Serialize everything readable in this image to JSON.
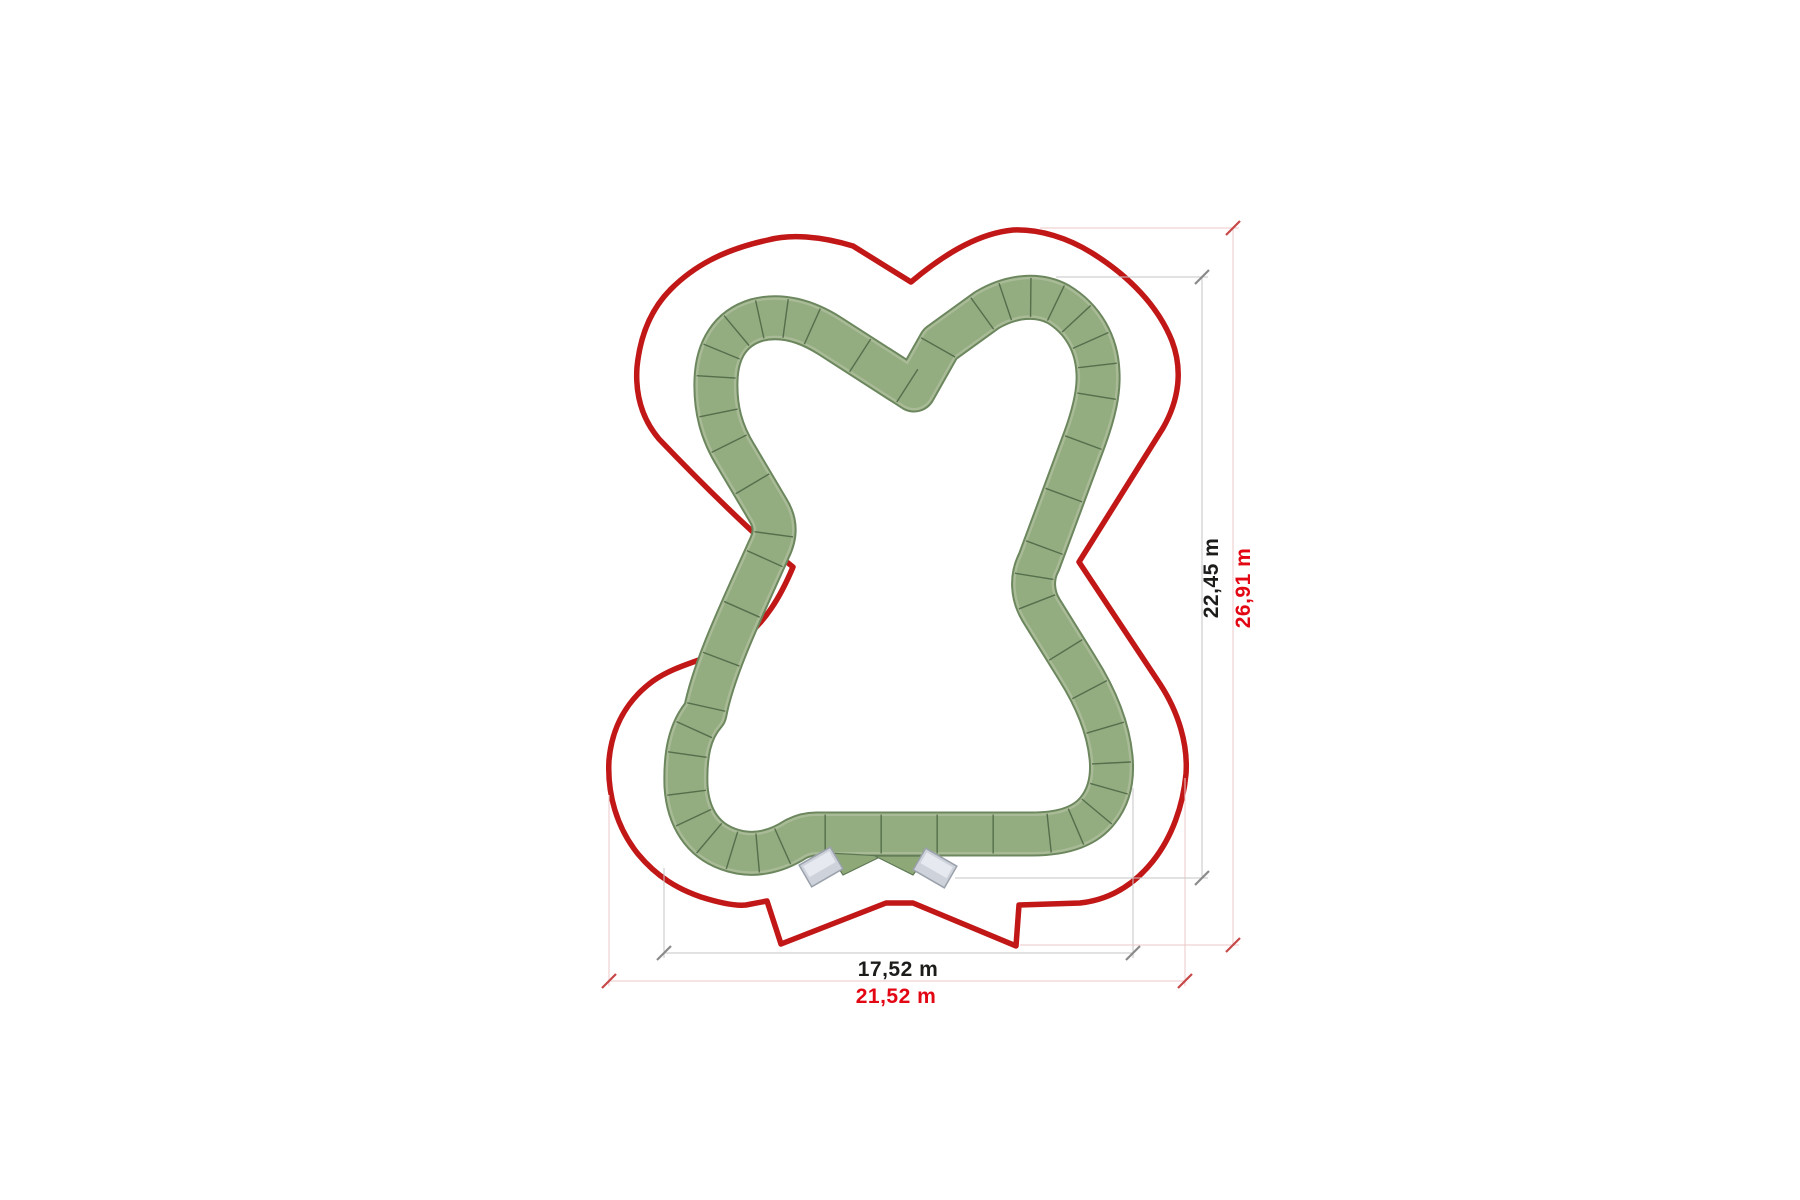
{
  "title": "Pump track plan view with dimensions",
  "units": "m",
  "colors": {
    "boundary_red": "#c21717",
    "label_black": "#1c1c1a",
    "label_red": "#e30613",
    "track_green": "#93ac80",
    "track_edge_green": "#6c875e",
    "track_rim_green": "#a9bb96",
    "divider_green": "#4f6847",
    "ramp_gray": "#ced3db",
    "ramp_border_gray": "#9aa1ab",
    "dim_gray_line": "#c6c6c6",
    "dim_red_line": "#ecc8c8"
  },
  "shapes": {
    "boundary_path": "M 911 282 L 853 246 C 820 236 790 234 768 240 C 722 250 693 267 671 289 C 650 310 640 337 637 367 C 635 396 643 420 659 439 C 703 485 757 538 793 567 C 780 598 765 622 742 640 C 712 660 680 662 653 681 C 627 700 612 727 609 760 C 607 794 617 828 638 854 C 657 877 678 889 701 897 C 720 903 736 906 746 905 L 767 901 L 781 944 L 886 903 L 913 903 L 1016 946 L 1019 905 L 1080 903 C 1108 900 1133 886 1153 861 C 1172 837 1183 806 1186 774 C 1188 745 1179 713 1160 684 L 1079 562 L 1163 428 C 1179 400 1183 370 1172 341 C 1158 306 1129 276 1092 253 C 1068 238 1040 229 1013 230 C 982 233 949 250 911 282 Z",
    "track_centerline": "M 914 390 L 830 336 C 805 320 780 314 757 320 C 730 328 717 350 716 380 C 715 408 721 432 736 456 L 768 510 C 776 523 776 535 769 549 C 745 603 714 666 705 713 C 689 731 685 756 686 786 C 688 818 703 840 728 849 C 752 858 776 852 796 839 C 802 836 808 834 816 834 L 1032 834 C 1062 834 1085 827 1098 810 C 1110 795 1113 777 1111 757 C 1108 727 1096 698 1077 668 L 1041 610 C 1032 595 1031 577 1039 562 L 1085 438 C 1094 413 1099 392 1098 373 C 1097 344 1083 319 1058 304 C 1037 293 1011 296 987 310 L 940 344 L 914 390 Z",
    "wedge_left_points": "829,853 882,856 843,875",
    "wedge_right_points": "875,856 927,856 913,875"
  },
  "ramps": [
    {
      "name": "start-ramp-left",
      "cx": 821,
      "cy": 867,
      "angle": -30,
      "w": 36,
      "h": 25
    },
    {
      "name": "start-ramp-right",
      "cx": 935,
      "cy": 868,
      "angle": 30,
      "w": 36,
      "h": 25
    }
  ],
  "dimensions": {
    "horizontal": [
      {
        "name": "track-width",
        "label": "17,52 m",
        "style": "gray",
        "y": 953,
        "x1": 664,
        "x2": 1133,
        "ext": [
          [
            664,
            868,
            958
          ],
          [
            1133,
            788,
            958
          ]
        ]
      },
      {
        "name": "site-width",
        "label": "21,52 m",
        "style": "red",
        "y": 981,
        "x1": 609,
        "x2": 1185,
        "ext": [
          [
            609,
            795,
            986
          ],
          [
            1185,
            778,
            986
          ]
        ]
      }
    ],
    "vertical": [
      {
        "name": "track-height",
        "label": "22,45 m",
        "style": "gray",
        "x": 1202,
        "y1": 277,
        "y2": 878,
        "ext": [
          [
            277,
            1056,
            1208
          ],
          [
            878,
            955,
            1208
          ]
        ]
      },
      {
        "name": "site-height",
        "label": "26,91 m",
        "style": "red",
        "x": 1233,
        "y1": 228,
        "y2": 945,
        "ext": [
          [
            228,
            1040,
            1239
          ],
          [
            945,
            1020,
            1239
          ]
        ]
      }
    ]
  }
}
